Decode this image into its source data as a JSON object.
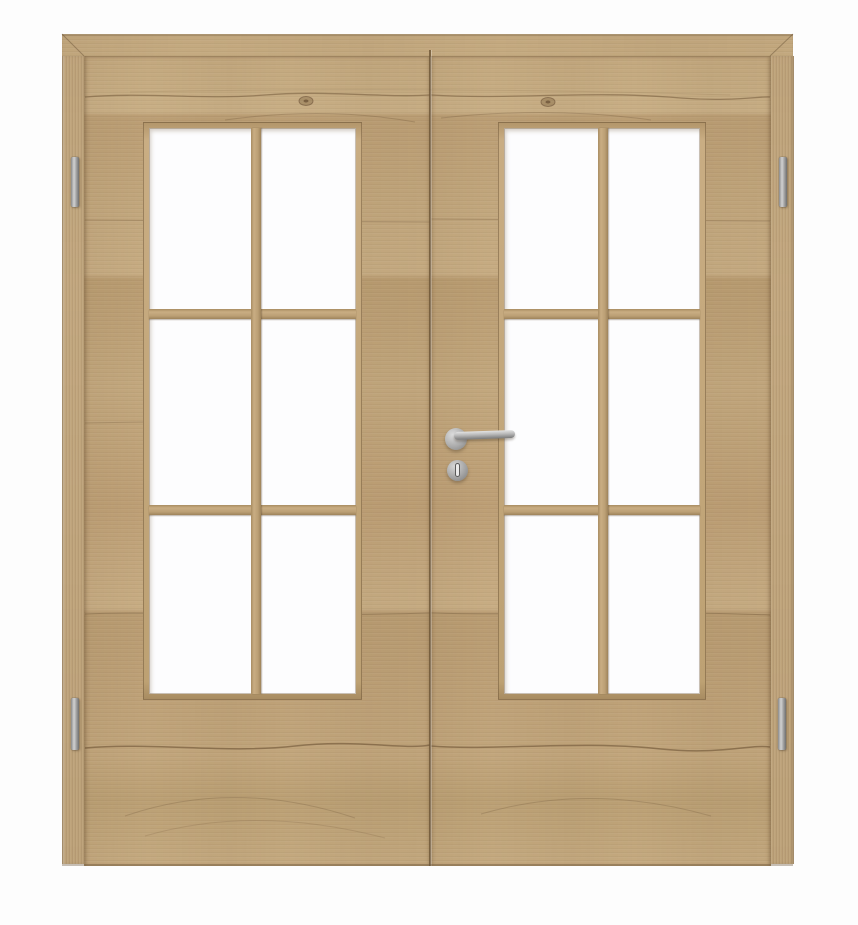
{
  "meta": {
    "type": "product-photo",
    "subject": "double-leaf interior door with glazing, light rustic oak finish, on white background",
    "background_color": "#fdfdfd"
  },
  "door": {
    "leaf_count": 2,
    "frame": {
      "visible_sides": [
        "top",
        "left",
        "right"
      ],
      "corner_joint": "mitred"
    },
    "wood": {
      "base_color": "#c0a479",
      "light_color": "#c9af86",
      "dark_color": "#8f7350",
      "grain_direction_leaves": "horizontal",
      "grain_line_color": "#6e5637",
      "features": [
        "horizontal plank joints",
        "knots",
        "cathedral grain arcs"
      ]
    },
    "seam": {
      "position": "center-vertical",
      "color": "#6e5637"
    },
    "glazing": {
      "panels_per_leaf": 1,
      "rows": 3,
      "cols": 2,
      "panes_per_leaf": 6,
      "glass_color": "#fdfdfe",
      "glass_finish": "frosted-white",
      "muntin_thickness_px": 10,
      "muntin_material": "wood"
    }
  },
  "hardware": {
    "finish": "stainless-steel",
    "metal_color": "#b5b5b5",
    "handle": {
      "type": "lever-handle-on-round-rose",
      "mounted_on": "right-leaf-meeting-stile",
      "lever_direction": "right"
    },
    "escutcheon": {
      "type": "round-keyhole-escutcheon",
      "keyhole_color": "#eaeaea"
    },
    "hinges": {
      "count": 4,
      "positions": [
        "left-top",
        "left-bottom",
        "right-top",
        "right-bottom"
      ]
    }
  }
}
